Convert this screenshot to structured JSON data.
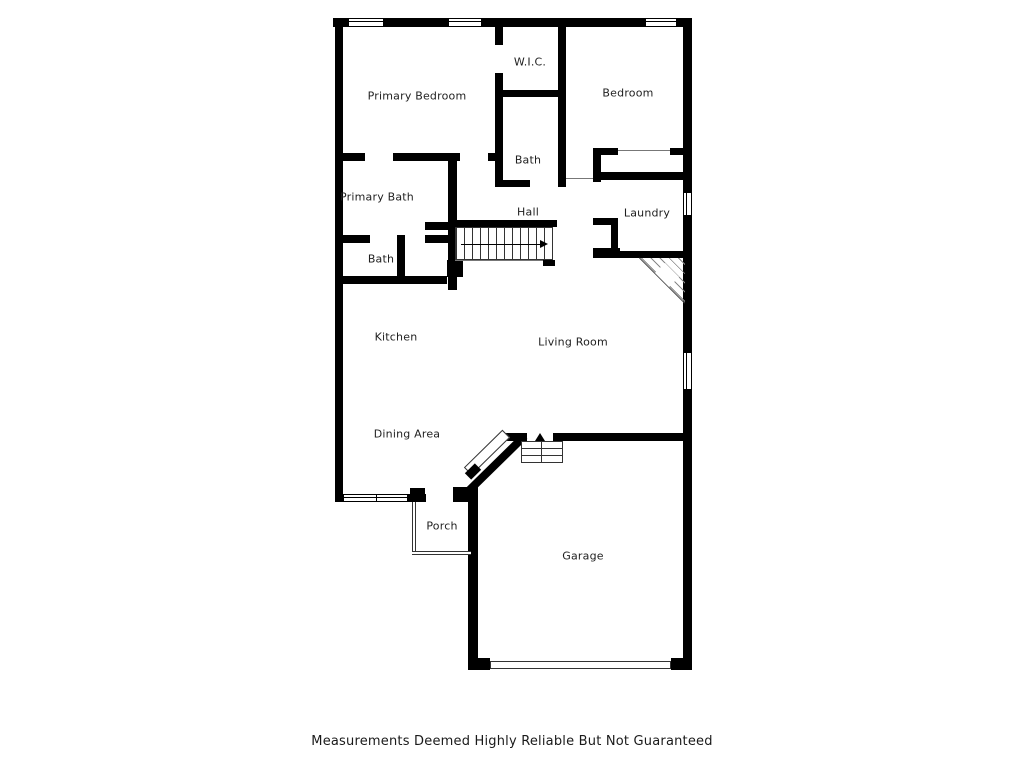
{
  "page": {
    "background": "#ffffff",
    "wall_color": "#000000",
    "label_color": "#1f1f1f"
  },
  "footer": {
    "disclaimer": "Measurements Deemed Highly Reliable But Not Guaranteed"
  },
  "floorplan": {
    "rooms": [
      {
        "label": "Primary Bedroom",
        "x": 417,
        "y": 96
      },
      {
        "label": "W.I.C.",
        "x": 530,
        "y": 62
      },
      {
        "label": "Bedroom",
        "x": 628,
        "y": 93
      },
      {
        "label": "Bath",
        "x": 528,
        "y": 160
      },
      {
        "label": "Primary Bath",
        "x": 377,
        "y": 197
      },
      {
        "label": "Hall",
        "x": 528,
        "y": 212
      },
      {
        "label": "Laundry",
        "x": 647,
        "y": 213
      },
      {
        "label": "Bath",
        "x": 381,
        "y": 259
      },
      {
        "label": "Kitchen",
        "x": 396,
        "y": 337
      },
      {
        "label": "Living Room",
        "x": 573,
        "y": 342
      },
      {
        "label": "Dining Area",
        "x": 407,
        "y": 434
      },
      {
        "label": "Porch",
        "x": 442,
        "y": 526
      },
      {
        "label": "Garage",
        "x": 583,
        "y": 556
      }
    ],
    "walls": [
      [
        333,
        18,
        359,
        9
      ],
      [
        335,
        18,
        8,
        484
      ],
      [
        683,
        18,
        9,
        174
      ],
      [
        683,
        216,
        9,
        136
      ],
      [
        683,
        390,
        9,
        280
      ],
      [
        408,
        494,
        18,
        8
      ],
      [
        456,
        494,
        12,
        8
      ],
      [
        410,
        488,
        15,
        14
      ],
      [
        453,
        487,
        17,
        15
      ],
      [
        468,
        487,
        10,
        183
      ],
      [
        500,
        433,
        27,
        8
      ],
      [
        553,
        433,
        139,
        8
      ],
      [
        468,
        658,
        22,
        12
      ],
      [
        671,
        658,
        21,
        12
      ],
      [
        495,
        27,
        8,
        18
      ],
      [
        495,
        73,
        8,
        114
      ],
      [
        498,
        90,
        64,
        7
      ],
      [
        558,
        27,
        8,
        160
      ],
      [
        498,
        180,
        32,
        7
      ],
      [
        335,
        153,
        30,
        8
      ],
      [
        393,
        153,
        67,
        8
      ],
      [
        488,
        153,
        10,
        8
      ],
      [
        448,
        153,
        9,
        137
      ],
      [
        425,
        222,
        23,
        8
      ],
      [
        425,
        235,
        23,
        8
      ],
      [
        335,
        235,
        35,
        8
      ],
      [
        397,
        235,
        8,
        42
      ],
      [
        335,
        276,
        112,
        8
      ],
      [
        447,
        260,
        16,
        17
      ],
      [
        448,
        220,
        109,
        7
      ],
      [
        543,
        260,
        12,
        6
      ],
      [
        593,
        148,
        25,
        7
      ],
      [
        670,
        148,
        13,
        7
      ],
      [
        593,
        172,
        90,
        8
      ],
      [
        593,
        148,
        8,
        34
      ],
      [
        593,
        218,
        24,
        7
      ],
      [
        611,
        218,
        7,
        33
      ],
      [
        593,
        248,
        27,
        7
      ],
      [
        593,
        251,
        90,
        7
      ]
    ],
    "windows": [
      [
        348,
        18,
        36,
        9,
        "h",
        1
      ],
      [
        448,
        18,
        34,
        9,
        "h",
        1
      ],
      [
        645,
        18,
        32,
        9,
        "h",
        1
      ],
      [
        683,
        192,
        9,
        24,
        "v",
        1
      ],
      [
        683,
        352,
        9,
        38,
        "v",
        1
      ],
      [
        343,
        494,
        65,
        8,
        "h",
        2
      ]
    ],
    "thin_lines": [
      [
        618,
        150,
        52,
        1
      ],
      [
        566,
        178,
        27,
        1
      ],
      [
        455,
        260,
        88,
        1
      ]
    ],
    "stairs": {
      "x": 455,
      "y": 227,
      "w": 98,
      "h": 33
    },
    "entry_steps": {
      "x": 521,
      "y": 441,
      "w": 42,
      "h": 22,
      "arrow_x": 535,
      "arrow_y": 433
    },
    "fireplace": {
      "x": 640,
      "y": 258,
      "size": 45,
      "diamond": 20,
      "diamond_left": 15,
      "diamond_top": 9
    },
    "garage_door": [
      490,
      661,
      181,
      8
    ],
    "porch": {
      "left": [
        412,
        502,
        4,
        51
      ],
      "bottom": [
        412,
        551,
        59,
        4
      ]
    },
    "diagonals": [
      {
        "type": "door",
        "cx": 487,
        "cy": 452,
        "len": 54,
        "thick": 11,
        "angle": -44.5
      },
      {
        "type": "wall",
        "cx": 473,
        "cy": 471,
        "len": 14,
        "thick": 9,
        "angle": -44.5
      },
      {
        "type": "wall",
        "cx": 496,
        "cy": 464,
        "len": 80,
        "thick": 8,
        "angle": -44.5
      },
      {
        "type": "line",
        "cx": 662,
        "cy": 280,
        "len": 64,
        "thick": 1,
        "angle": 45
      }
    ]
  }
}
